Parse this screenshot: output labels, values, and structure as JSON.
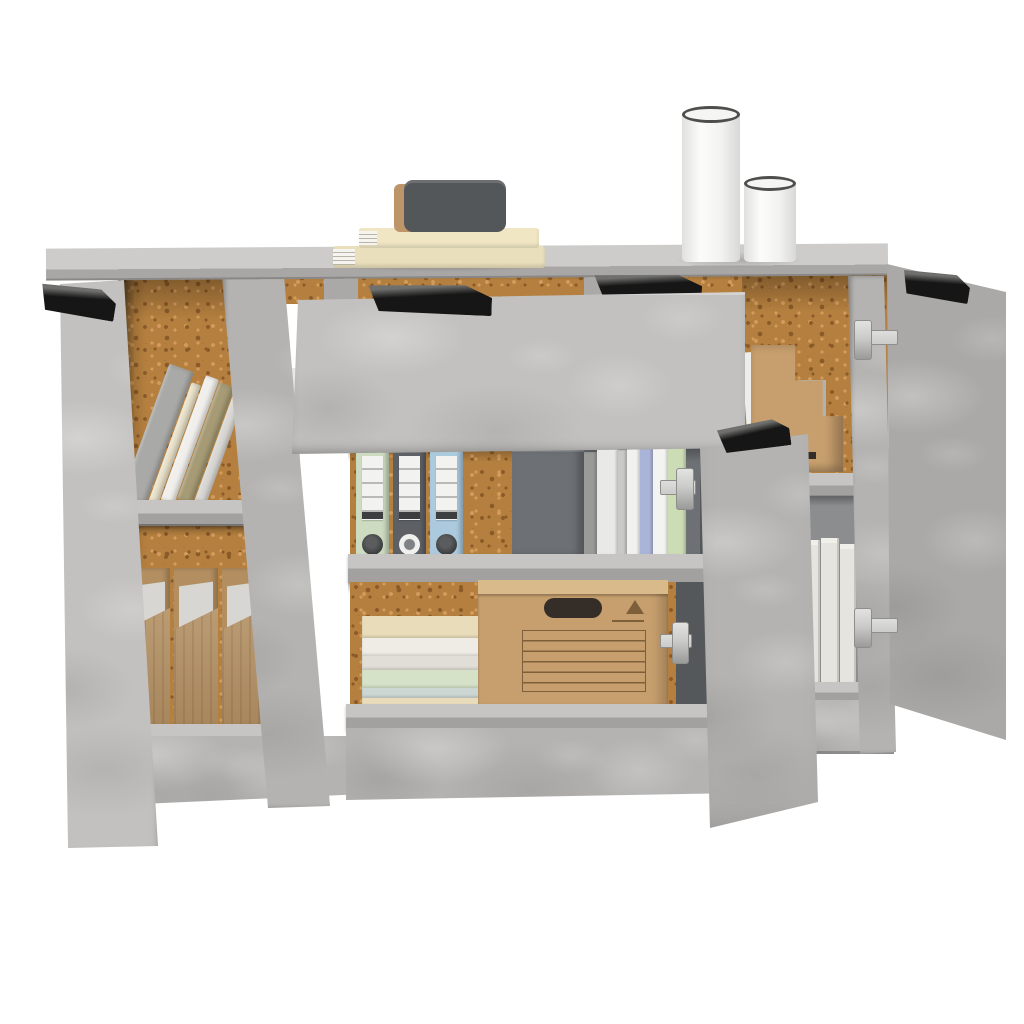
{
  "scene": {
    "description": "Product photo: 3-piece sideboard in concrete gray on white background, open left door, open middle drawer and doors revealing cork-backed shelves with books, binders, magazine files, paper stacks and cardboard boxes; decor books and two white canisters on top",
    "items": [
      "left-door-open",
      "left-leaning-books",
      "left-magazine-files",
      "middle-open-drawer",
      "middle-binders",
      "middle-upright-books",
      "middle-paper-stack",
      "middle-cardboard-box",
      "middle-door-open",
      "right-step-file-holder",
      "right-white-books",
      "right-door-open",
      "decor-book-stack",
      "decor-dark-case",
      "tall-canister",
      "short-canister"
    ]
  },
  "colors": {
    "bg": "#ffffff",
    "top_face": "#cdccca",
    "top_edge": "#a8a7a5",
    "concrete_light": "#c2c1bf",
    "concrete_mid": "#b4b3b1",
    "concrete_dark": "#aba9a7",
    "shelf_top": "#c6c5c3",
    "shelf_front": "#a2a19f",
    "cork": "#b5803f",
    "cork_dark": "#8a5a28",
    "cork_light": "#d49c5c",
    "interior_dark": "#6d7175",
    "interior_deep": "#55585b",
    "interior_gray": "#8b8d8f",
    "handle": "#161616",
    "handle_hi": "#6f6f6d",
    "hinge": "#cbcbc9",
    "hinge_dark": "#8e8e8c",
    "file_front": "#b28e60",
    "file_paper": "#d7d6d2",
    "label_white": "#f2f2f0",
    "ring_dark": "#3a3c3e",
    "box_front": "#c79f6e",
    "box_top": "#d9ba8a",
    "box_print": "#7d5f3a",
    "slot_dark": "#352e28",
    "wbook": "#e6e4de",
    "wbook_line": "#c6c4be",
    "wbook_top": "#f1efe9",
    "cyl": "#f5f5f3",
    "cyl_rim": "#4e4e4c",
    "deco_book1": "#e9dfbc",
    "deco_book2": "#f0e6c4",
    "deco_dark": "#54575a",
    "deco_tan": "#bd9569",
    "page": "#f6f4ee",
    "page_line": "#b8b4a8"
  },
  "left_books": {
    "colors": [
      "#a9a9a7",
      "#e9e2cb",
      "#f0efeb",
      "#a69b75",
      "#d8d7d3"
    ],
    "widths": [
      26,
      10,
      14,
      16,
      12
    ],
    "heights": [
      140,
      126,
      132,
      124,
      116
    ],
    "lean_deg": 20
  },
  "mag_files": {
    "count": 3
  },
  "binders": {
    "colors": [
      "#cddcc0",
      "#5d6165",
      "#abcade"
    ],
    "rings": [
      "dark",
      "light",
      "dark"
    ]
  },
  "mid_books": {
    "colors": [
      "#9a9a98",
      "#e9e9e7",
      "#c9c9c7",
      "#f1f1ef",
      "#aab4d8",
      "#f3f3f1",
      "#ccdcb4"
    ],
    "widths": [
      13,
      21,
      9,
      13,
      13,
      15,
      18
    ],
    "tops": [
      14,
      6,
      12,
      4,
      10,
      8,
      2
    ]
  },
  "stack_layers": {
    "colors": [
      "#e8dcba",
      "#efece6",
      "#e0ded6",
      "#d6e2c8",
      "#ccd6d2",
      "#e8dcba"
    ],
    "heights": [
      22,
      18,
      14,
      18,
      10,
      14
    ]
  },
  "white_books": {
    "widths": [
      16,
      18,
      16
    ],
    "heights": [
      148,
      150,
      144
    ]
  }
}
